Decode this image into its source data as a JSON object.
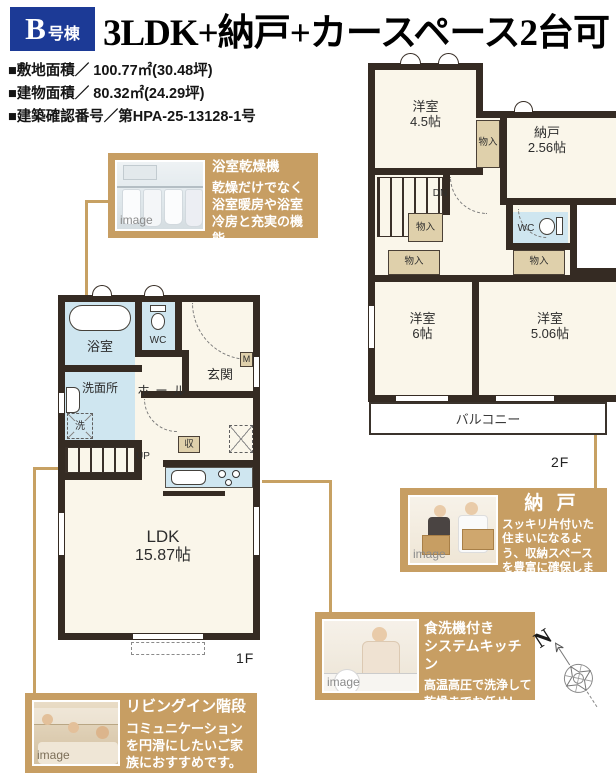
{
  "header": {
    "badge_letter": "B",
    "badge_suffix": "号棟",
    "title": "3LDK+納戸+カースペース2台可"
  },
  "specs": [
    "■敷地面積／ 100.77㎡(30.48坪)",
    "■建物面積／ 80.32㎡(24.29坪)",
    "■建築確認番号／第HPA-25-13128-1号"
  ],
  "floor2": {
    "room45_name": "洋室",
    "room45_size": "4.5帖",
    "closet": "物入",
    "nando_name": "納戸",
    "nando_size": "2.56帖",
    "stairs_dn": "DN",
    "wc": "WC",
    "room6_name": "洋室",
    "room6_size": "6帖",
    "room506_name": "洋室",
    "room506_size": "5.06帖",
    "balcony": "バルコニー",
    "floor_label": "2F"
  },
  "floor1": {
    "bath": "浴室",
    "wc": "WC",
    "washroom": "洗面所",
    "hall": "ホ ー ル",
    "entrance": "玄関",
    "meter": "M",
    "washer": "洗",
    "stairs_up": "UP",
    "storage": "収",
    "ldk_name": "LDK",
    "ldk_size": "15.87帖",
    "floor_label": "1F"
  },
  "callouts": {
    "dryer": {
      "title": "浴室乾燥機",
      "body": "乾燥だけでなく浴室暖房や浴室冷房と充実の機能。",
      "watermark": "image"
    },
    "nando": {
      "title": "納 戸",
      "body": "スッキリ片付いた住まいになるよう、収納スペースを豊富に確保しました。",
      "watermark": "image"
    },
    "kitchen": {
      "title_line1": "食洗機付き",
      "title_line2": "システムキッチン",
      "body": "高温高圧で洗浄して乾燥までお任せ！",
      "watermark": "image"
    },
    "living_stairs": {
      "title": "リビングイン階段",
      "body": "コミュニケーションを円滑にしたいご家族におすすめです。",
      "watermark": "image"
    }
  },
  "compass": {
    "north_label": "N"
  },
  "colors": {
    "accent_tan": "#c79e63",
    "badge_blue": "#1c3a96",
    "wall_dark": "#352b23",
    "water_blue": "#cfe6f0",
    "closet_beige": "#dfd0ab"
  }
}
